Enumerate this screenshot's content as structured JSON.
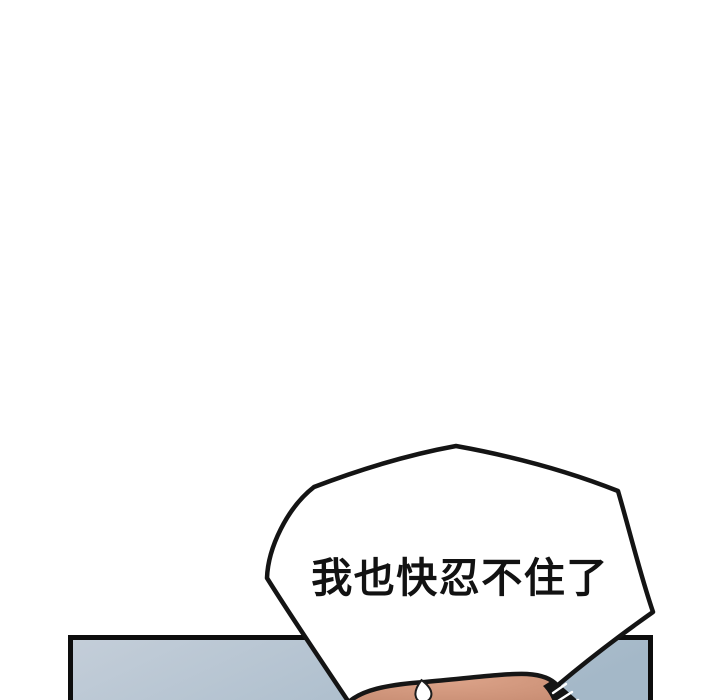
{
  "page": {
    "background_color": "#ffffff"
  },
  "speech_bubble": {
    "text": "我也快忍不住了",
    "fill": "#ffffff",
    "outline_color": "#141414",
    "text_color": "#121212"
  },
  "panel": {
    "border_color": "#0d0d0d",
    "fill_left": "#c4ced9",
    "fill_right": "#a4b8c8"
  },
  "character": {
    "skin_light": "#dca389",
    "skin_shadow": "#bd8167",
    "hair_color": "#151515",
    "sweat_drop_fill": "#ffffff"
  }
}
